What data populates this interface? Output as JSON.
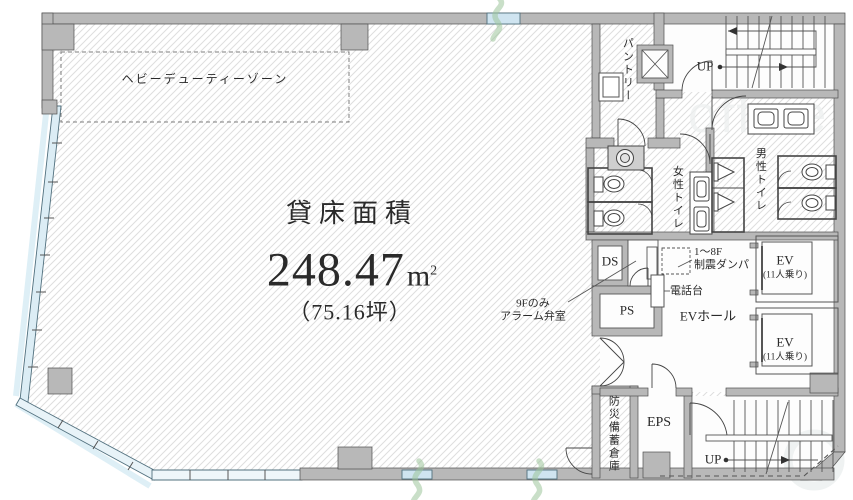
{
  "plan": {
    "watermark": "office",
    "heavy_duty_zone": "ヘビーデューティーゾーン",
    "area": {
      "title": "貸床面積",
      "value": "248.47",
      "unit_base": "m",
      "unit_sup": "2",
      "tsubo": "（75.16坪）"
    },
    "rooms": {
      "pantry": "パントリー",
      "womens_toilet": "女性トイレ",
      "mens_toilet": "男性トイレ",
      "ev_hall": "EVホール",
      "ds": "DS",
      "ps": "PS",
      "eps": "EPS",
      "disaster_storage": "防災備蓄倉庫"
    },
    "labels": {
      "up_top": "UP",
      "up_bottom": "UP",
      "damper_line1": "1～8F",
      "damper_line2": "制震ダンパ",
      "phone_stand": "電話台",
      "alarm_line1": "9Fのみ",
      "alarm_line2": "アラーム弁室"
    },
    "elevators": [
      {
        "name": "EV",
        "capacity": "(11人乗り)"
      },
      {
        "name": "EV",
        "capacity": "(11人乗り)"
      }
    ],
    "colors": {
      "wall": "#b8b8b8",
      "glass": "#cfe4f0",
      "hatch": "#dedede",
      "accent_green": "#9dc49a"
    }
  }
}
